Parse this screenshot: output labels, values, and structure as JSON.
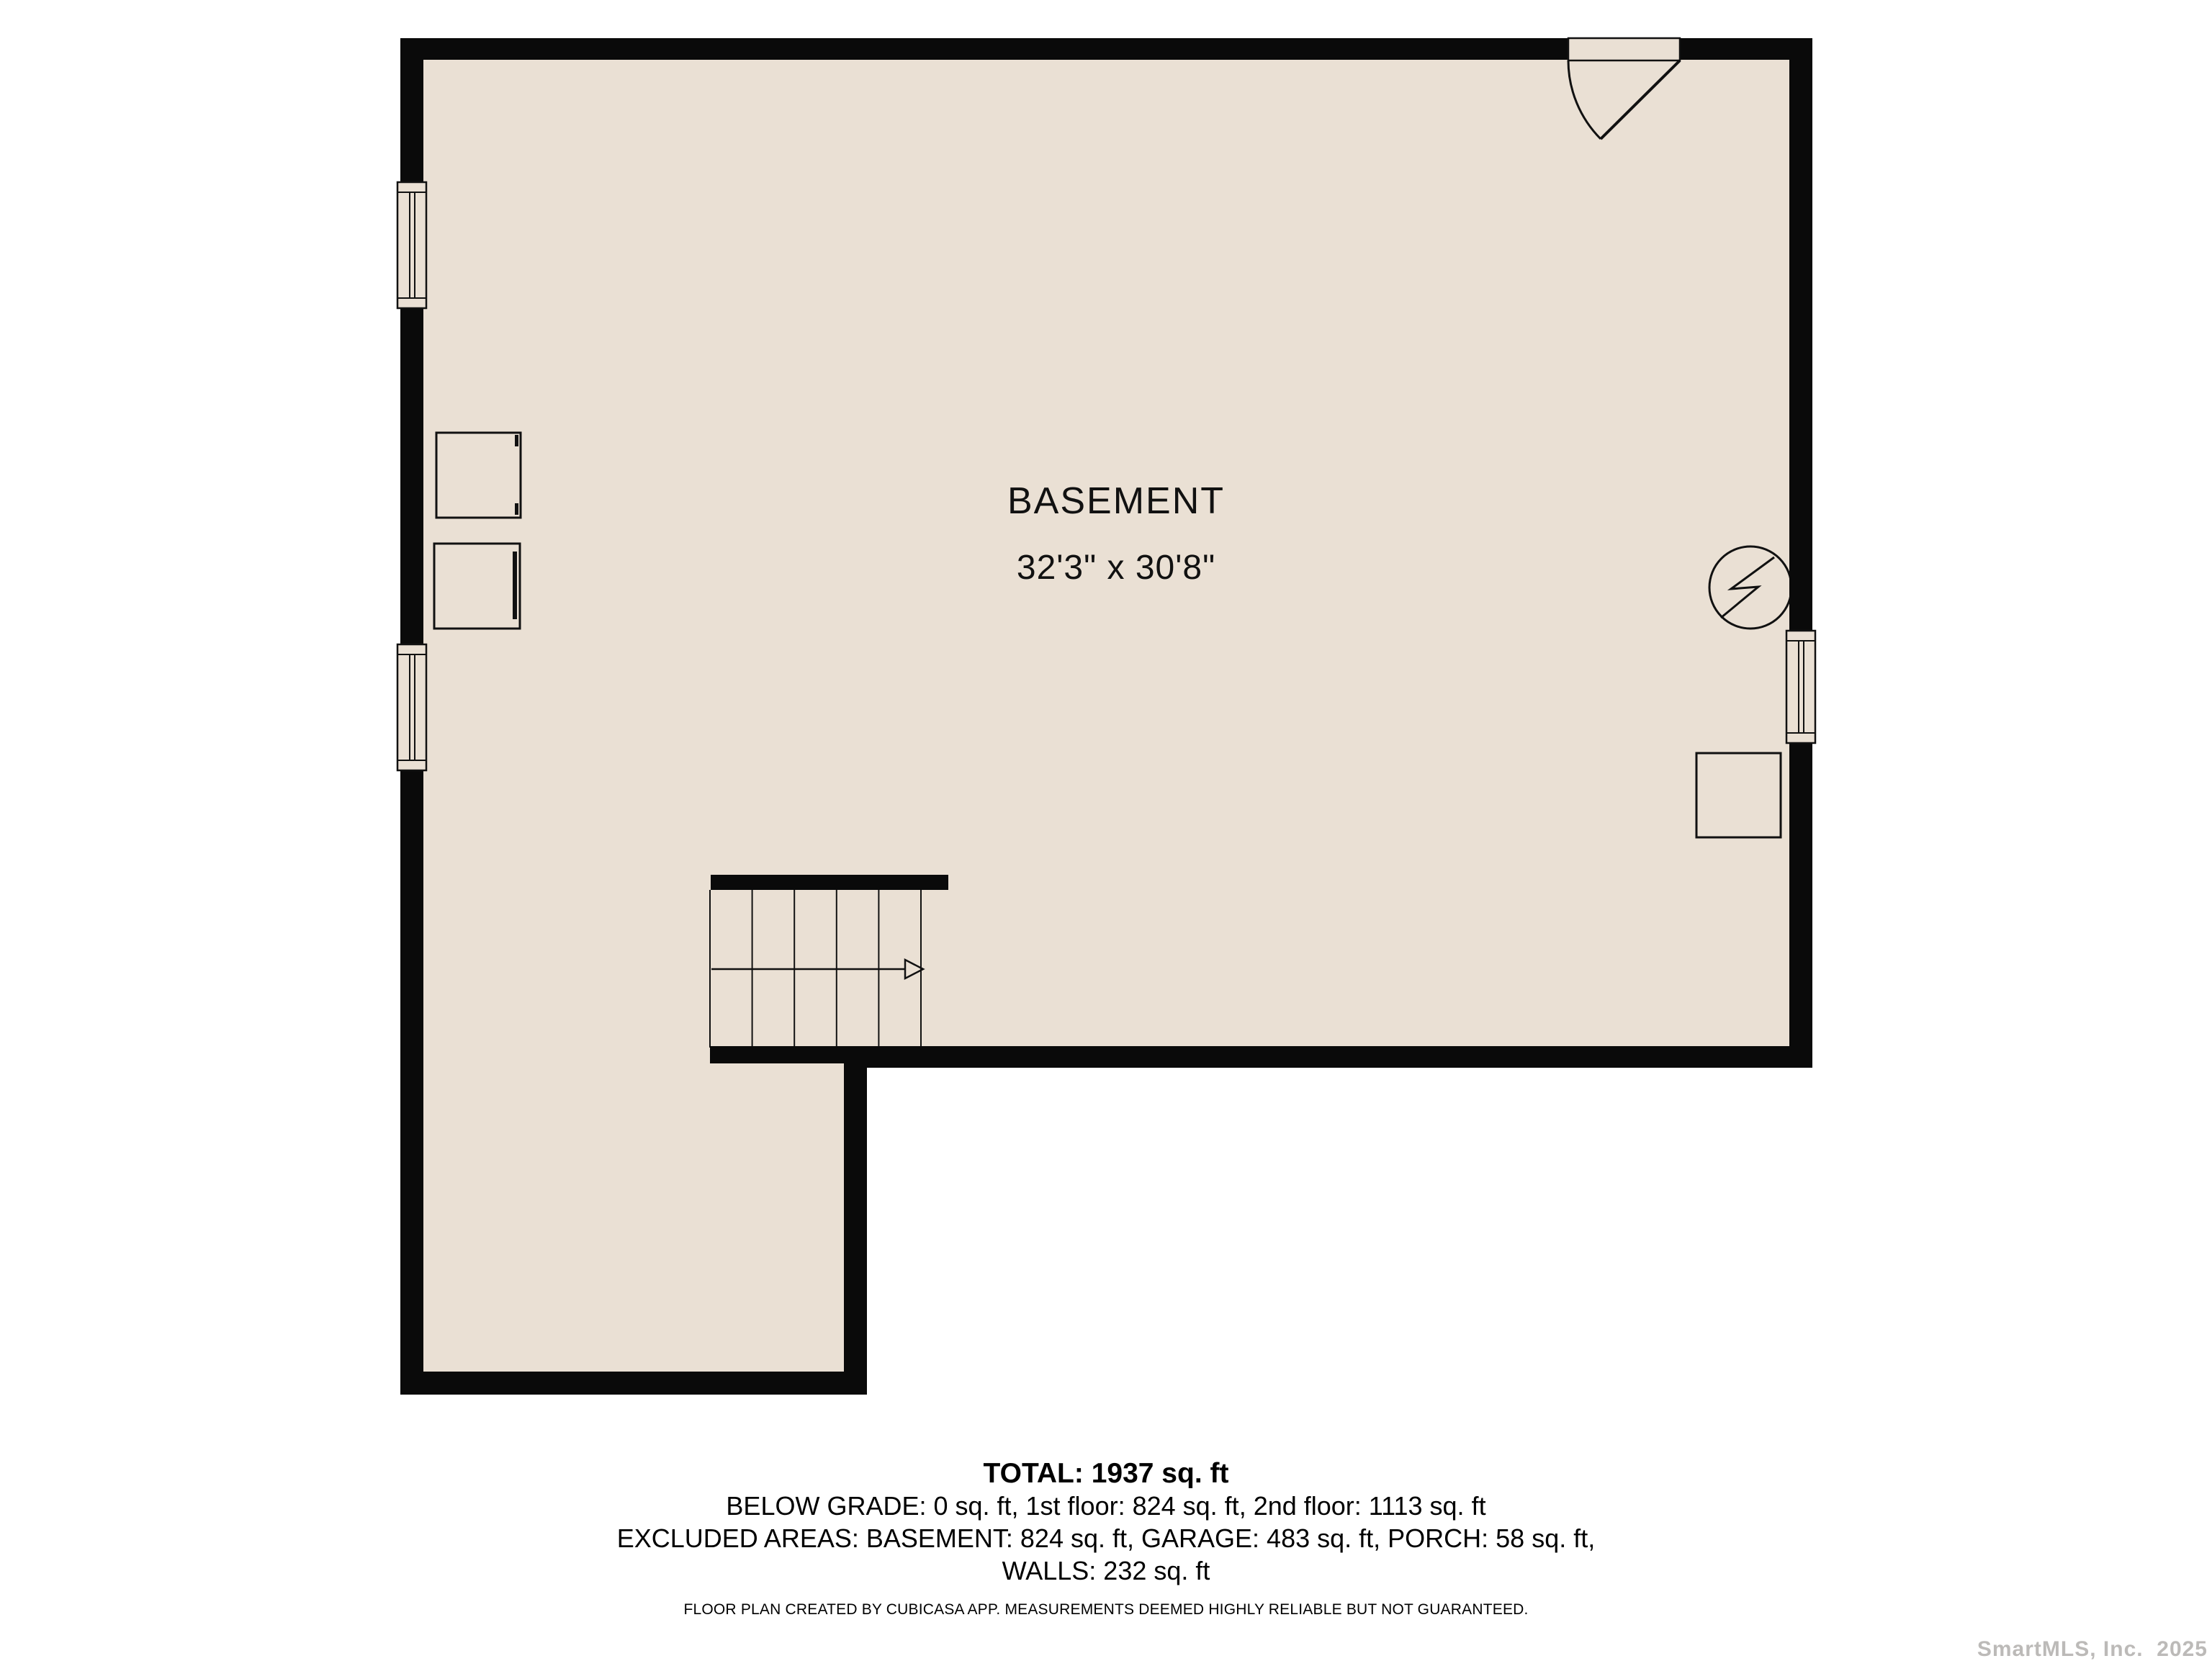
{
  "plan": {
    "room_label": "BASEMENT",
    "room_dimensions": "32'3\" x 30'8\""
  },
  "summary": {
    "total_line": "TOTAL: 1937 sq. ft",
    "lines": [
      "BELOW GRADE: 0 sq. ft, 1st floor: 824 sq. ft, 2nd floor: 1113 sq. ft",
      "EXCLUDED AREAS: BASEMENT: 824 sq. ft, GARAGE: 483 sq. ft, PORCH: 58 sq. ft,",
      "WALLS: 232 sq. ft"
    ]
  },
  "disclaimer": "FLOOR PLAN CREATED BY CUBICASA APP. MEASUREMENTS DEEMED HIGHLY RELIABLE BUT NOT GUARANTEED.",
  "watermark": "SmartMLS, Inc.  2025",
  "colors": {
    "floor": "#EAE0D4",
    "wall": "#0A0A0A",
    "line": "#111111",
    "background": "#FFFFFF",
    "watermark": "#BCBAB8"
  }
}
